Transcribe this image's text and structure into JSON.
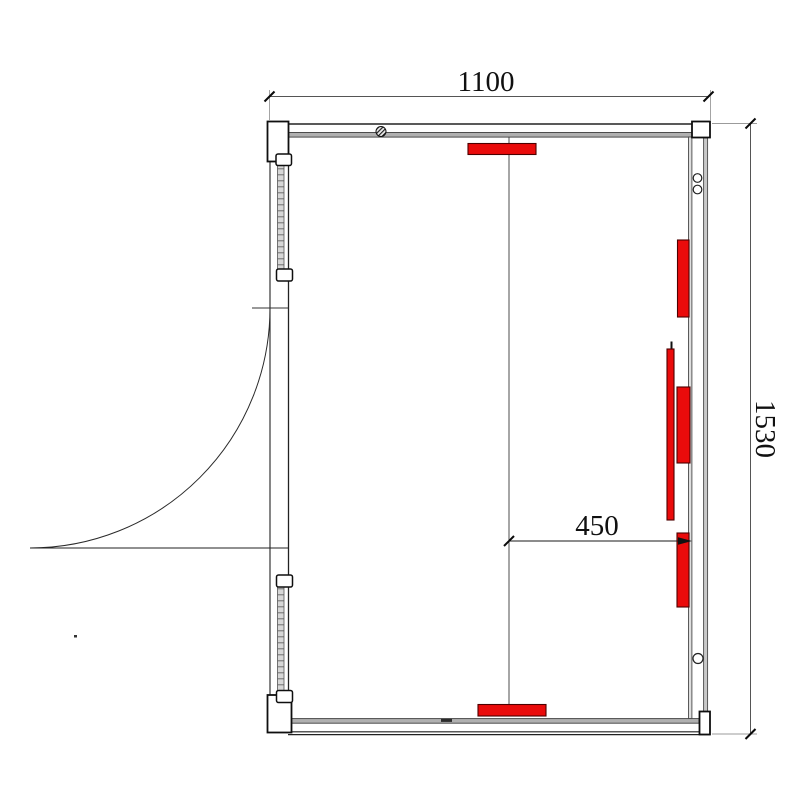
{
  "figure": {
    "kind": "sauna-room-floor-plan",
    "dims": {
      "width_label": "1100",
      "depth_label": "1530",
      "offset_label": "450"
    },
    "colors": {
      "heater_fill": "#ea0b0b",
      "wall_fill": "#b0b0b0"
    }
  }
}
